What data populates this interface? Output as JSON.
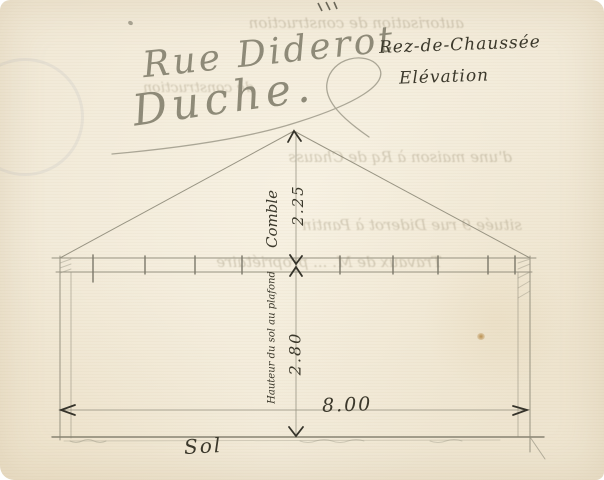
{
  "document": {
    "type": "scanned hand-drawn architectural elevation sketch",
    "annotations": {
      "street": "Rue Diderot",
      "owner": "Duche.",
      "floor": "Rez-de-Chaussée",
      "view": "Elévation"
    },
    "dimensions": {
      "attic_label": "Comble",
      "attic_height": "2.25",
      "room_label": "Hauteur du sol au plafond",
      "room_height": "2.80",
      "width": "8.00",
      "ground": "Sol"
    }
  },
  "bleedthrough": {
    "rows": [
      {
        "text": "autorisation de construction"
      },
      {
        "text": "de construction"
      },
      {
        "text": "d'une maison à Rq de Chauss"
      },
      {
        "text": "située 9 rue Diderot à Pantin"
      },
      {
        "text": "Travaux de M. ... propriétaire"
      }
    ]
  },
  "colors": {
    "paper": "#f1e9d7",
    "pencil": "#8f8b7a",
    "ink": "#3b382b"
  }
}
